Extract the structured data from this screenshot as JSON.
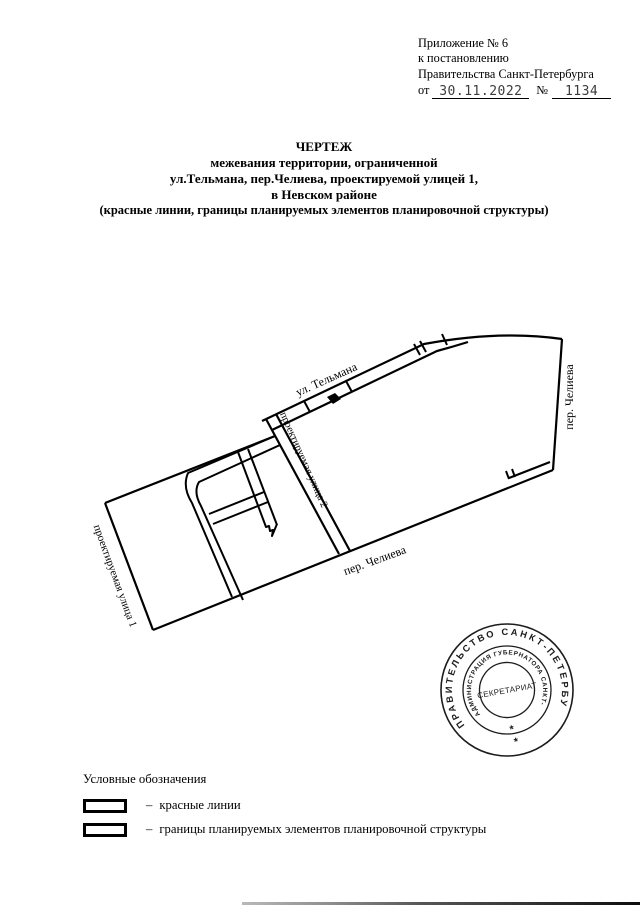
{
  "header": {
    "line1": "Приложение № 6",
    "line2": "к постановлению",
    "line3": "Правительства Санкт-Петербурга",
    "from_label": "от",
    "date": "30.11.2022",
    "number_sign": "№",
    "number": "1134"
  },
  "title": {
    "line1": "ЧЕРТЕЖ",
    "line2": "межевания территории, ограниченной",
    "line3": "ул.Тельмана,  пер.Челиева,  проектируемой улицей 1,",
    "line4": "в Невском районе",
    "line5": "(красные линии, границы планируемых элементов планировочной структуры)"
  },
  "map": {
    "labels": {
      "telmana": "ул. Тельмана",
      "chelieva_right": "пер. Челиева",
      "chelieva_bottom": "пер. Челиева",
      "street1": "проектируемая улица 1",
      "street2": "проектируемая улица 2"
    }
  },
  "stamp": {
    "outer_text": "ПРАВИТЕЛЬСТВО  САНКТ-ПЕТЕРБУРГА",
    "inner_text": "АДМИНИСТРАЦИЯ ГУБЕРНАТОРА САНКТ-ПЕТЕРБУРГА",
    "center_text": "СЕКРЕТАРИАТ",
    "star": "*"
  },
  "legend": {
    "title": "Условные обозначения",
    "dash": "–",
    "items": [
      {
        "label": "красные линии"
      },
      {
        "label": "границы планируемых элементов планировочной структуры"
      }
    ]
  },
  "colors": {
    "ink": "#000000",
    "paper": "#ffffff",
    "stamp_ink": "#1c1c1c"
  }
}
